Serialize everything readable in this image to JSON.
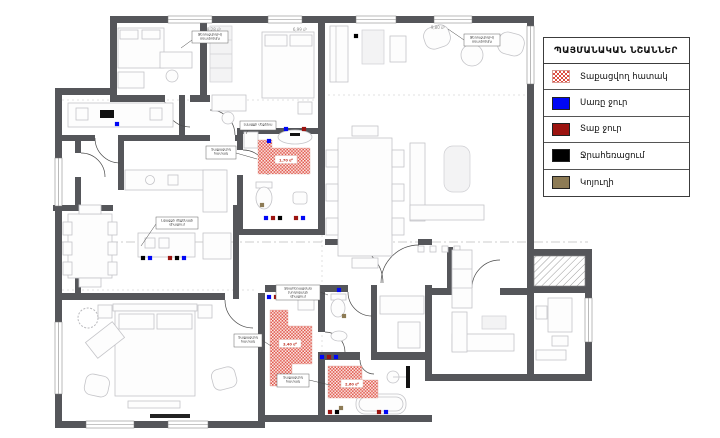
{
  "colors": {
    "wall": "#55565a",
    "cold": "#0007f5",
    "hot": "#9c1410",
    "drain": "#000000",
    "sewer": "#8d7b55",
    "hatch": "#e0584c"
  },
  "legend": {
    "title": "ՊԱՅՄԱՆԱԿԱՆ ՆՇԱՆՆԵՐ",
    "items": [
      {
        "type": "hatch",
        "icon": "heated-floor-swatch",
        "label": "Տաքացվող հատակ"
      },
      {
        "type": "solid",
        "icon": "cold-water-swatch",
        "color": "#0007f5",
        "label": "Սառը ջուր"
      },
      {
        "type": "solid",
        "icon": "hot-water-swatch",
        "color": "#9c1410",
        "label": "Տաք ջուր"
      },
      {
        "type": "solid",
        "icon": "drainage-swatch",
        "color": "#000000",
        "label": "Ջրահեռացում"
      },
      {
        "type": "solid",
        "icon": "sewer-swatch",
        "color": "#8d7b55",
        "label": "Կոյուղի"
      }
    ]
  },
  "plan": {
    "area_labels": [
      {
        "x": 214,
        "y": 31,
        "text": "8,28 մ²"
      },
      {
        "x": 300,
        "y": 31,
        "text": "6,99 մ²"
      },
      {
        "x": 438,
        "y": 29,
        "text": "9,80 մ²"
      }
    ],
    "hatch_labels": [
      {
        "x": 286,
        "y": 160,
        "text": "1,70 մ²"
      },
      {
        "x": 290,
        "y": 344,
        "text": "3,40 մ²"
      },
      {
        "x": 352,
        "y": 384,
        "text": "2,60 մ²"
      }
    ],
    "hatch_areas": [
      {
        "d": "M258,140 h14 v8 h38 v26 h-52 z"
      },
      {
        "d": "M270,310 h18 v16 h24 v38 h-20 v22 h-22 z"
      },
      {
        "d": "M328,366 h34 v14 h16 v18 h-50 z"
      }
    ],
    "annotations": [
      {
        "x": 192,
        "y": 31,
        "w": 36,
        "h": 12,
        "lines": [
          "Ջեռուցվող(Վ)",
          "օդափոխիչ"
        ],
        "leader": [
          192,
          40,
          181,
          48
        ]
      },
      {
        "x": 464,
        "y": 34,
        "w": 36,
        "h": 12,
        "lines": [
          "Ջեռուցվող(Վ)",
          "օդափոխիչ"
        ],
        "leader": [
          464,
          40,
          448,
          29
        ]
      },
      {
        "x": 240,
        "y": 121,
        "w": 36,
        "h": 9,
        "lines": [
          "Լվացքի մեքենա"
        ],
        "leader": [
          248,
          130,
          246,
          134
        ]
      },
      {
        "x": 206,
        "y": 146,
        "w": 30,
        "h": 13,
        "lines": [
          "Տաքացվող",
          "հատակ"
        ],
        "leader": [
          236,
          153,
          257,
          159
        ]
      },
      {
        "x": 156,
        "y": 217,
        "w": 42,
        "h": 12,
        "lines": [
          "Լվացքի մեքենայի",
          "միացում"
        ],
        "leader": [
          156,
          224,
          141,
          246
        ]
      },
      {
        "x": 276,
        "y": 285,
        "w": 44,
        "h": 15,
        "lines": [
          "Ջրահեռացման",
          "խողովակի",
          "միացում"
        ],
        "leader": [
          320,
          292,
          328,
          295
        ]
      },
      {
        "x": 277,
        "y": 374,
        "w": 32,
        "h": 13,
        "lines": [
          "Տաքացվող",
          "հատակ"
        ],
        "leader": [
          309,
          380,
          330,
          385
        ]
      },
      {
        "x": 234,
        "y": 334,
        "w": 28,
        "h": 13,
        "lines": [
          "Տաքացվող",
          "հատակ"
        ],
        "leader": [
          262,
          340,
          271,
          346
        ]
      }
    ],
    "dots": [
      {
        "x": 286,
        "y": 129,
        "c": "cold"
      },
      {
        "x": 304,
        "y": 129,
        "c": "hot"
      },
      {
        "x": 266,
        "y": 218,
        "c": "cold"
      },
      {
        "x": 273,
        "y": 218,
        "c": "hot"
      },
      {
        "x": 280,
        "y": 218,
        "c": "drain"
      },
      {
        "x": 296,
        "y": 218,
        "c": "hot"
      },
      {
        "x": 303,
        "y": 218,
        "c": "cold"
      },
      {
        "x": 143,
        "y": 258,
        "c": "drain"
      },
      {
        "x": 150,
        "y": 258,
        "c": "cold"
      },
      {
        "x": 170,
        "y": 258,
        "c": "hot"
      },
      {
        "x": 177,
        "y": 258,
        "c": "drain"
      },
      {
        "x": 184,
        "y": 258,
        "c": "cold"
      },
      {
        "x": 269,
        "y": 141,
        "c": "cold"
      },
      {
        "x": 356,
        "y": 36,
        "c": "drain"
      },
      {
        "x": 117,
        "y": 124,
        "c": "cold"
      },
      {
        "x": 322,
        "y": 357,
        "c": "cold"
      },
      {
        "x": 329,
        "y": 357,
        "c": "hot"
      },
      {
        "x": 336,
        "y": 357,
        "c": "cold"
      },
      {
        "x": 330,
        "y": 412,
        "c": "hot"
      },
      {
        "x": 337,
        "y": 412,
        "c": "drain"
      },
      {
        "x": 379,
        "y": 412,
        "c": "hot"
      },
      {
        "x": 386,
        "y": 412,
        "c": "cold"
      },
      {
        "x": 269,
        "y": 297,
        "c": "cold"
      },
      {
        "x": 276,
        "y": 297,
        "c": "hot"
      },
      {
        "x": 339,
        "y": 290,
        "c": "cold"
      },
      {
        "x": 262,
        "y": 205,
        "c": "sewer"
      },
      {
        "x": 344,
        "y": 316,
        "c": "sewer"
      },
      {
        "x": 341,
        "y": 408,
        "c": "sewer"
      }
    ]
  }
}
